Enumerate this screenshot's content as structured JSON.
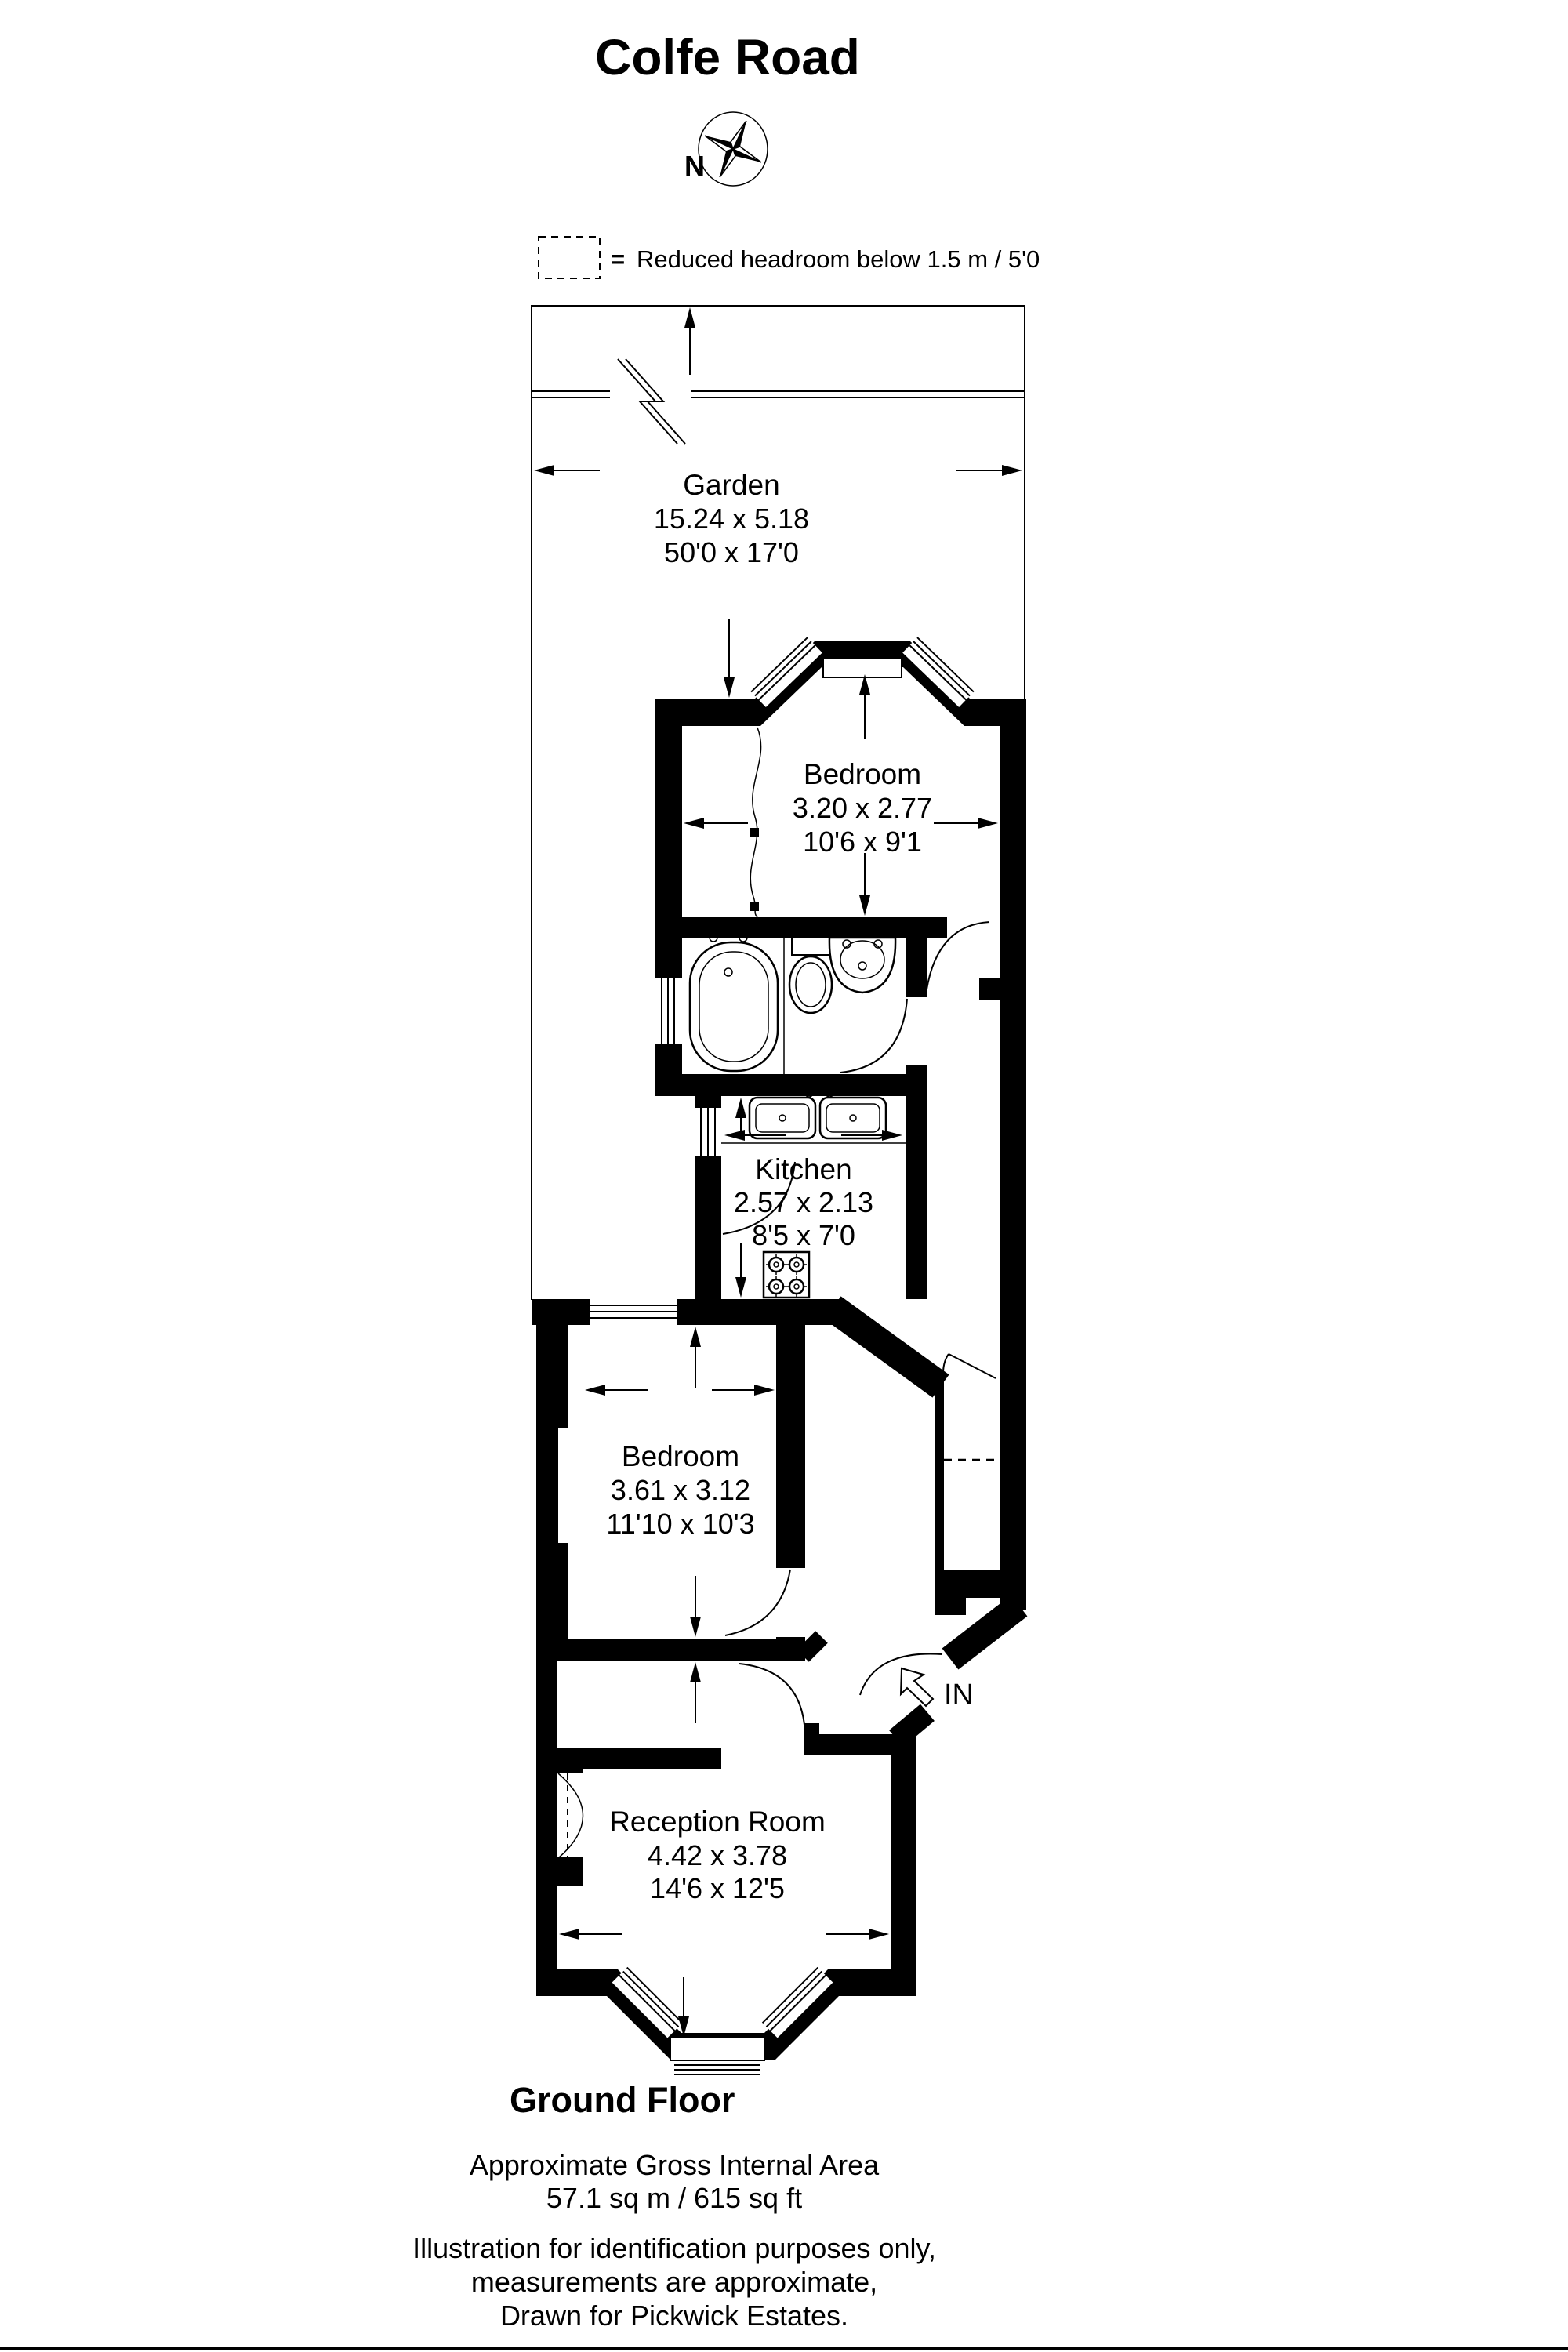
{
  "title": "Colfe Road",
  "compass": {
    "north_label": "N"
  },
  "legend": {
    "symbol": "=",
    "text": "Reduced headroom below 1.5 m / 5'0"
  },
  "rooms": [
    {
      "name": "Garden",
      "metric": "15.24 x 5.18",
      "imperial": "50'0 x 17'0"
    },
    {
      "name": "Bedroom",
      "metric": "3.20 x 2.77",
      "imperial": "10'6 x 9'1"
    },
    {
      "name": "Kitchen",
      "metric": "2.57 x 2.13",
      "imperial": "8'5 x 7'0"
    },
    {
      "name": "Bedroom",
      "metric": "3.61 x 3.12",
      "imperial": "11'10 x 10'3"
    },
    {
      "name": "Reception Room",
      "metric": "4.42 x 3.78",
      "imperial": "14'6 x 12'5"
    }
  ],
  "entrance_label": "IN",
  "floor_label": "Ground Floor",
  "area": {
    "line1": "Approximate Gross Internal Area",
    "line2": "57.1 sq m / 615 sq ft"
  },
  "disclaimer": [
    "Illustration for identification purposes only,",
    "measurements are approximate,",
    "Drawn for Pickwick Estates."
  ],
  "colors": {
    "ink": "#000000",
    "paper": "#ffffff"
  }
}
